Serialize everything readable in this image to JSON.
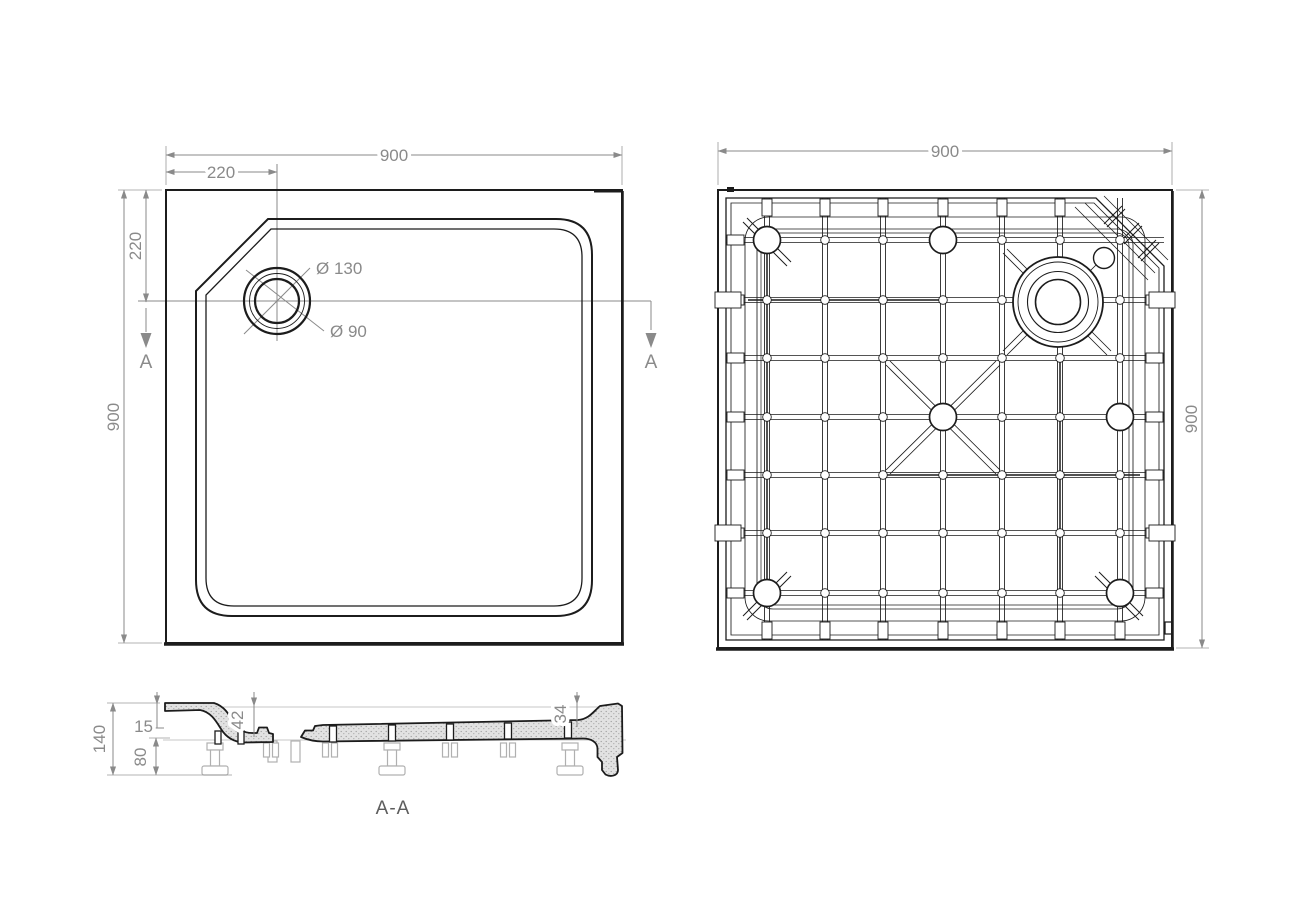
{
  "colors": {
    "line": "#1c1c1c",
    "dimension": "#8a8a8a",
    "section_fill": "#e2e2e2",
    "feet": "#b0b0b0",
    "background": "#ffffff"
  },
  "plan_view": {
    "dim_width_top": "900",
    "dim_drain_offset_top": "220",
    "dim_height_left": "900",
    "dim_drain_offset_left": "220",
    "label_drain_outer": "Ø 130",
    "label_drain_inner": "Ø 90",
    "section_marker_left": "A",
    "section_marker_right": "A"
  },
  "bottom_view": {
    "dim_width_top": "900",
    "dim_height_right": "900"
  },
  "section_view": {
    "dim_total_height": "140",
    "dim_rim_height": "15",
    "dim_foot_clearance": "80",
    "dim_depth_at_drain": "42",
    "dim_depth_at_edge": "34",
    "label": "A-A"
  }
}
